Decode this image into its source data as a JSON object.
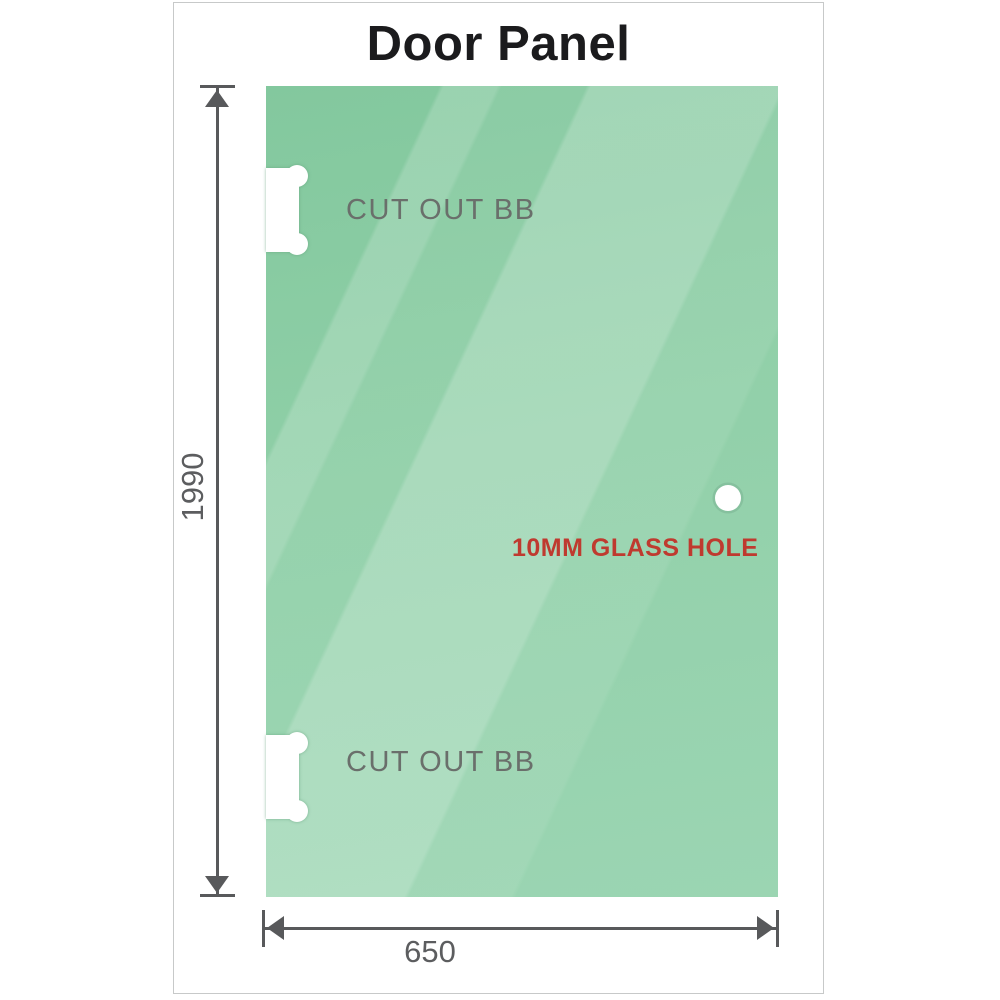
{
  "title": "Door Panel",
  "glass_panel": {
    "cutout_top_label": "CUT OUT BB",
    "cutout_bottom_label": "CUT OUT BB",
    "hole_label": "10MM GLASS HOLE"
  },
  "dimensions": {
    "height_value": "1990",
    "width_value": "650"
  },
  "icons": {
    "arrow_up": "css-triangle-up",
    "arrow_down": "css-triangle-down",
    "arrow_left": "css-triangle-left",
    "arrow_right": "css-triangle-right",
    "glass_hole": "white-circle",
    "hinge_cutout": "white-notch-with-round-lobes"
  },
  "colors": {
    "glass_green": "#8ecfa8",
    "glass_highlight": "#b9e2ca",
    "annotation_red": "#bf3a2f",
    "cutout_label_gray": "#6a6f6b",
    "dimension_gray": "#58595b",
    "title_color": "#1b1b1d",
    "frame_border": "#c7c9c9"
  }
}
